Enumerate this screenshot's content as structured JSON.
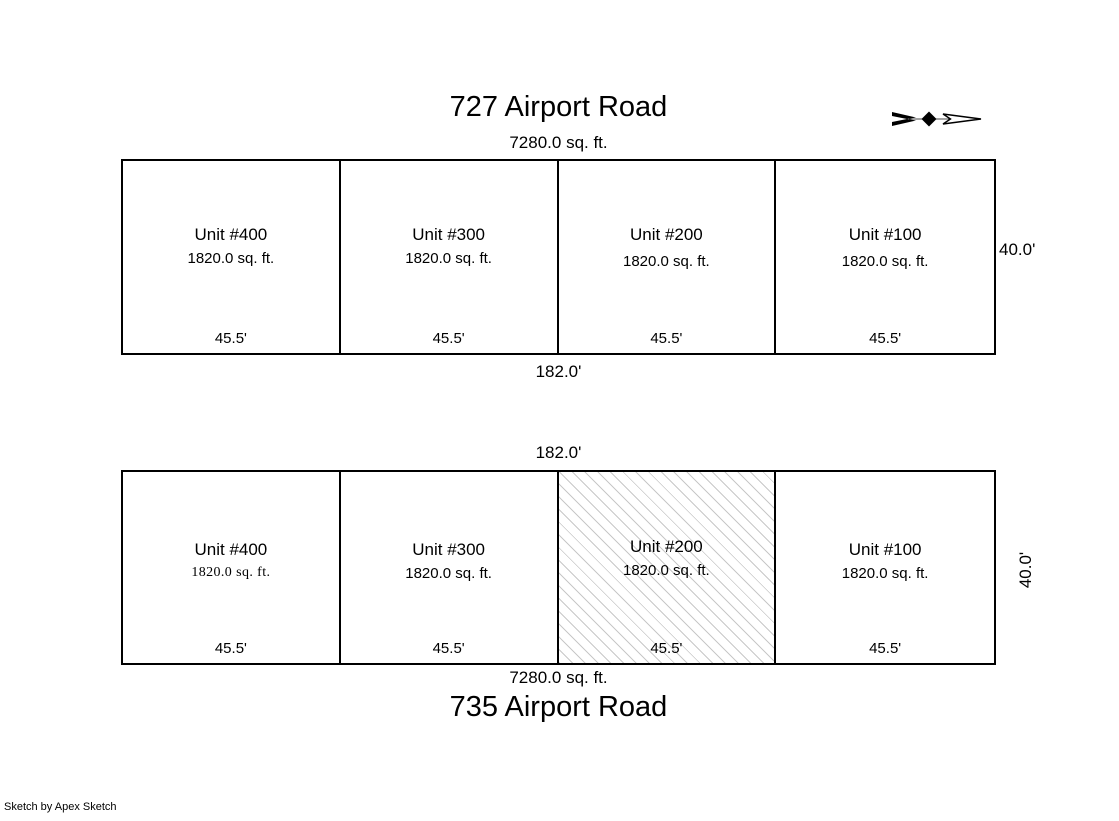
{
  "sketch": {
    "credit": "Sketch by Apex Sketch",
    "compass": {
      "icon": "north-arrow",
      "points": "right"
    },
    "colors": {
      "line": "#000000",
      "hatch": "#c8c8c8",
      "background": "#ffffff"
    },
    "building_top": {
      "title": "727 Airport Road",
      "total_area": "7280.0 sq. ft.",
      "length_label": "182.0'",
      "depth_label": "40.0'",
      "units": [
        {
          "name": "Unit #400",
          "area": "1820.0 sq. ft.",
          "frontage": "45.5'"
        },
        {
          "name": "Unit #300",
          "area": "1820.0 sq. ft.",
          "frontage": "45.5'"
        },
        {
          "name": "Unit #200",
          "area": "1820.0 sq. ft.",
          "frontage": "45.5'"
        },
        {
          "name": "Unit #100",
          "area": "1820.0 sq. ft.",
          "frontage": "45.5'"
        }
      ]
    },
    "building_bottom": {
      "title": "735 Airport Road",
      "total_area": "7280.0 sq. ft.",
      "length_label": "182.0'",
      "depth_label": "40.0'",
      "units": [
        {
          "name": "Unit #400",
          "area": "1820.0 sq. ft.",
          "frontage": "45.5'"
        },
        {
          "name": "Unit #300",
          "area": "1820.0 sq. ft.",
          "frontage": "45.5'"
        },
        {
          "name": "Unit #200",
          "area": "1820.0 sq. ft.",
          "frontage": "45.5'",
          "hatched": true
        },
        {
          "name": "Unit #100",
          "area": "1820.0 sq. ft.",
          "frontage": "45.5'"
        }
      ]
    }
  }
}
